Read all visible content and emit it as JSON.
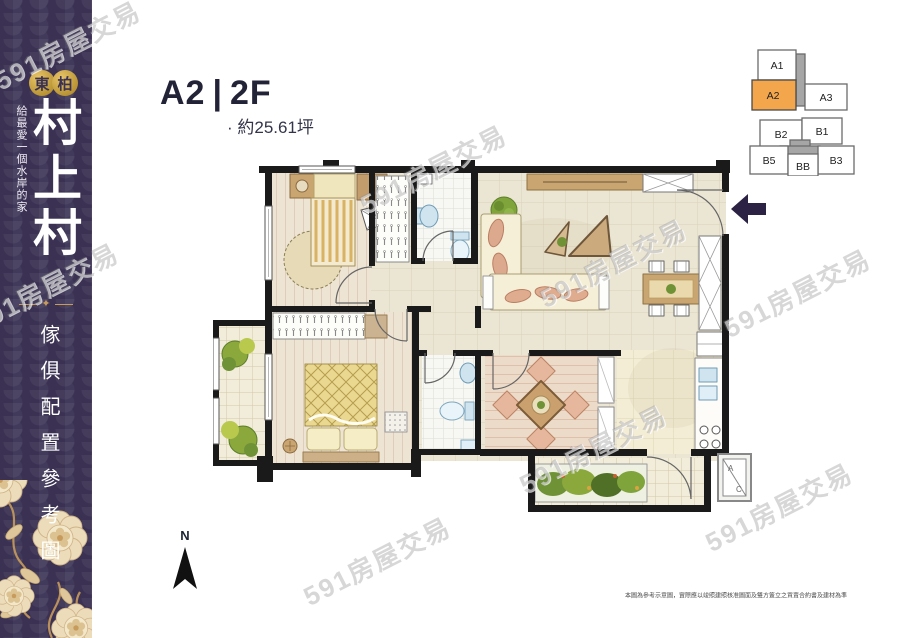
{
  "header": {
    "unit": "A2",
    "divider": "|",
    "floor": "2F",
    "area": "· 約25.61坪"
  },
  "sidebar": {
    "badge": [
      "東",
      "柏"
    ],
    "tagline": "給最愛一個水岸的家",
    "title": "村上村",
    "ornament": "✦",
    "caption": "傢俱配置參考圖",
    "colors": {
      "background": "#3A3153",
      "gold": "#C79B5C",
      "text": "#FFFFFF"
    }
  },
  "keyplan": {
    "highlight_color": "#F3A64B",
    "units": [
      {
        "label": "A1",
        "highlight": false
      },
      {
        "label": "A2",
        "highlight": true
      },
      {
        "label": "A3",
        "highlight": false
      },
      {
        "label": "B2",
        "highlight": false
      },
      {
        "label": "B1",
        "highlight": false
      },
      {
        "label": "B5",
        "highlight": false
      },
      {
        "label": "BB",
        "highlight": false
      },
      {
        "label": "B3",
        "highlight": false
      }
    ]
  },
  "compass": {
    "label": "N"
  },
  "ac_unit": {
    "line1": "A",
    "line2": "C"
  },
  "footer": {
    "disclaimer": "本圖為參考示意圖，實際應以竣照建照核准圖面及雙方簽立之買賣合約書及建材為準"
  },
  "watermark": {
    "text": "591房屋交易",
    "positions": [
      {
        "x": -14,
        "y": 26
      },
      {
        "x": -36,
        "y": 268
      },
      {
        "x": 352,
        "y": 150
      },
      {
        "x": 532,
        "y": 244
      },
      {
        "x": 716,
        "y": 274
      },
      {
        "x": 296,
        "y": 542
      },
      {
        "x": 698,
        "y": 488
      },
      {
        "x": 512,
        "y": 430
      }
    ]
  }
}
